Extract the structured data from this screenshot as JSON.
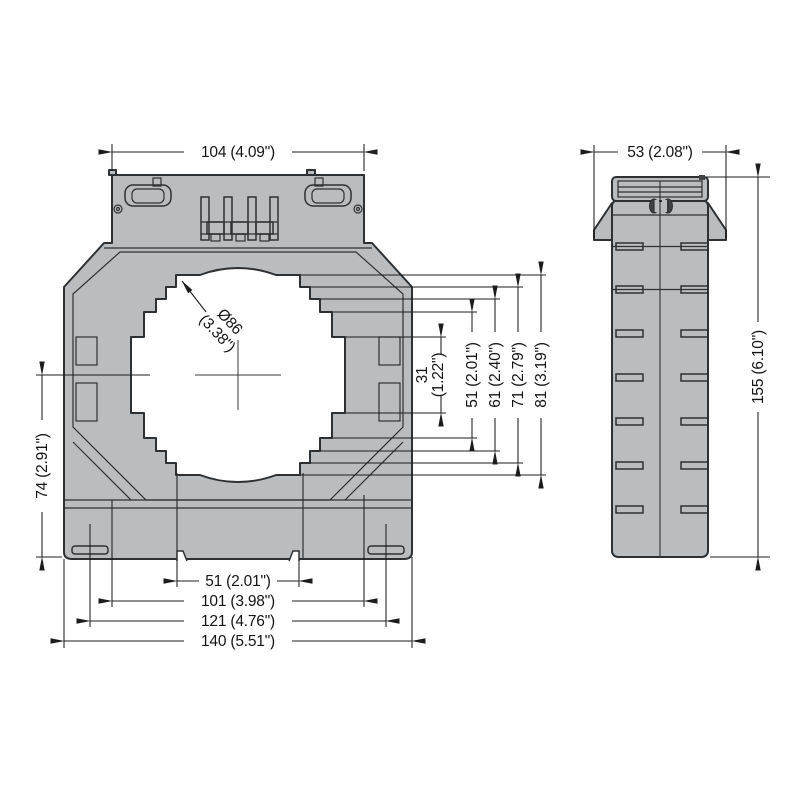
{
  "drawing": {
    "kind": "current-transformer dimension drawing",
    "views": {
      "front": "front view",
      "side": "side view"
    }
  },
  "front_view": {
    "dims": {
      "top_width": "104 (4.09\")",
      "window_dia_line1": "Ø86",
      "window_dia_line2": "(3.38\")",
      "step31_line1": "31",
      "step31_line2": "(1.22\")",
      "step51": "51 (2.01\")",
      "step61": "61 (2.40\")",
      "step71": "71 (2.79\")",
      "step81": "81 (3.19\")",
      "center_to_base": "74 (2.91\")",
      "notch_span": "51 (2.01\")",
      "seam_span": "101 (3.98\")",
      "slot_span": "121 (4.76\")",
      "overall_width": "140 (5.51\")"
    }
  },
  "side_view": {
    "dims": {
      "width": "53 (2.08\")",
      "overall_height": "155 (6.10\")"
    }
  },
  "colors": {
    "body_fill": "#b9bdbf",
    "outline": "#2e3133",
    "dimension": "#1c1c1c",
    "background": "#ffffff"
  }
}
